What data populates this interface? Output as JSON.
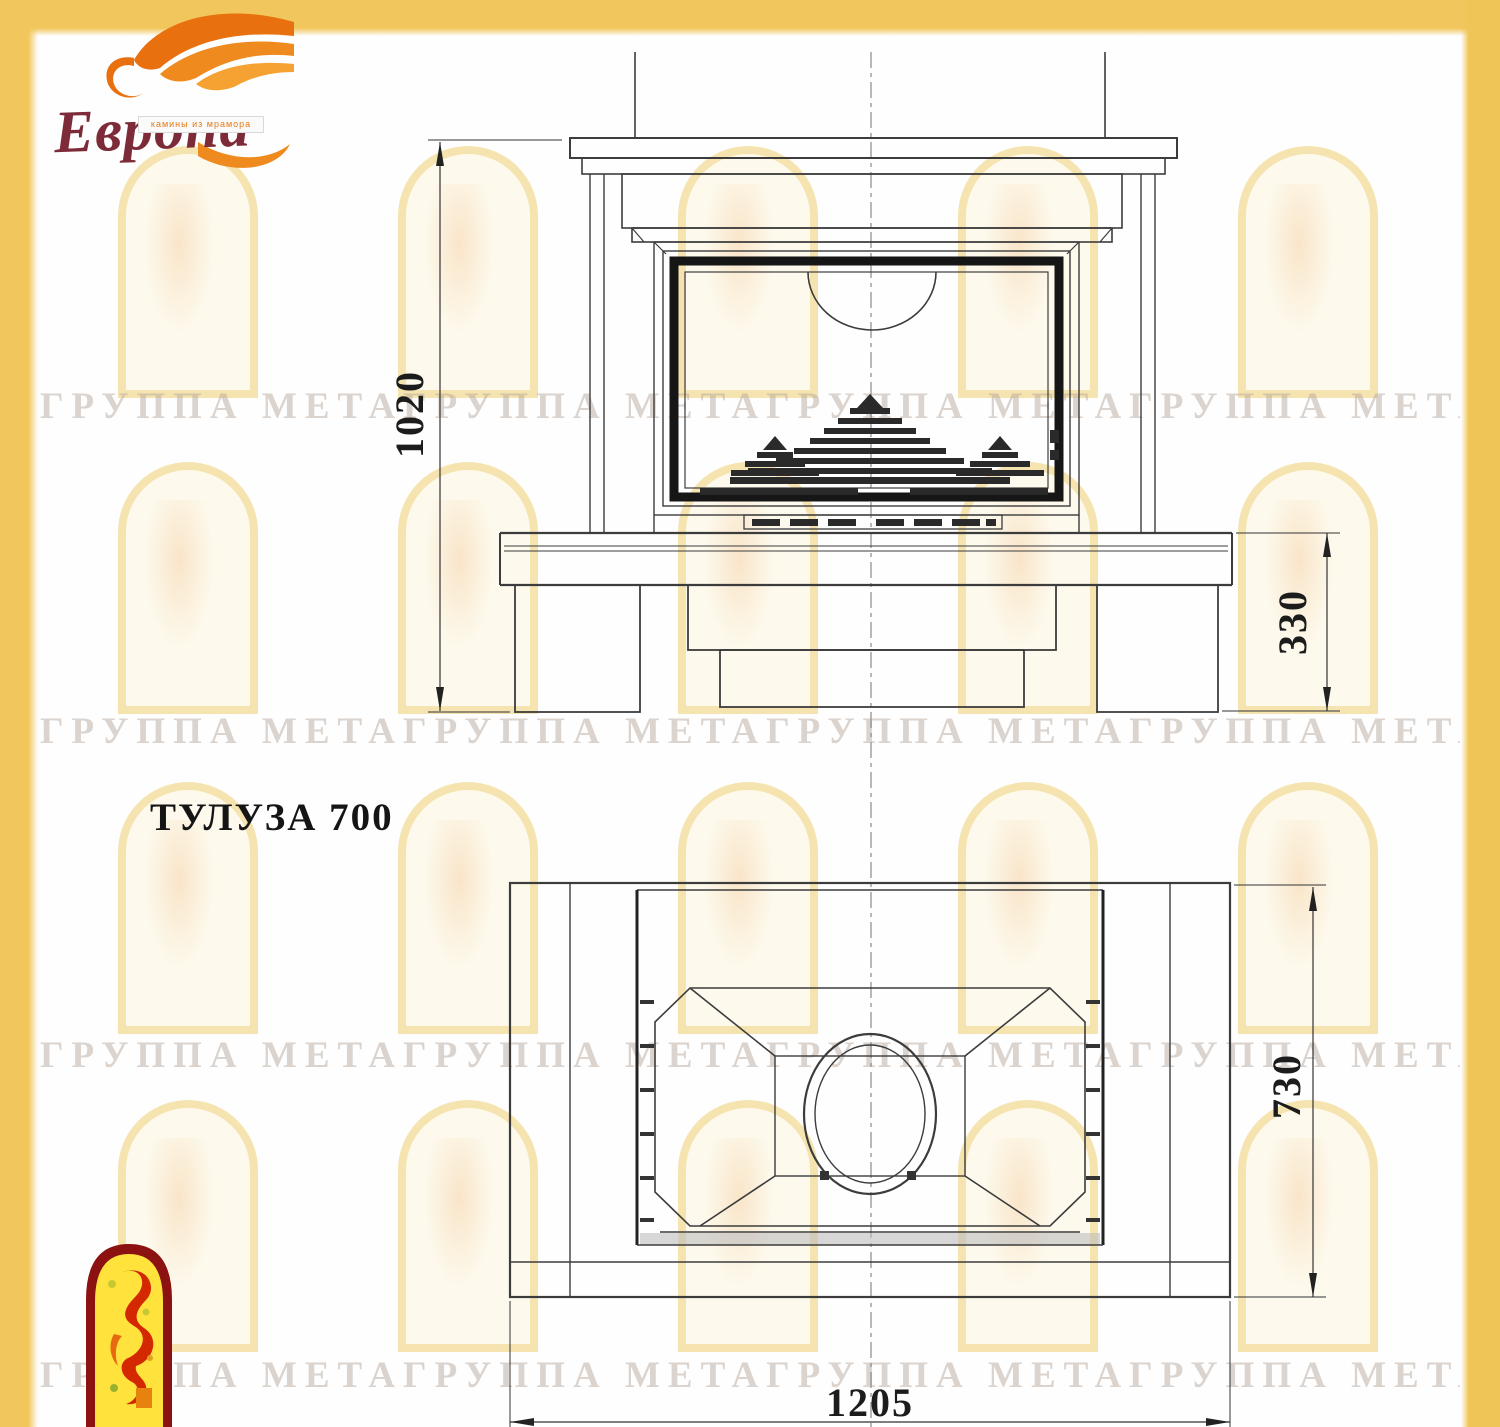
{
  "logo": {
    "brand": "Европа",
    "tagline": "камины из мрамора"
  },
  "title": "ТУЛУЗА 700",
  "dimensions": {
    "front_height_mm": "1020",
    "plinth_height_mm": "330",
    "plan_depth_mm": "730",
    "plan_width_mm": "1205"
  },
  "watermark": {
    "band_text": "ГРУППА МЕТАГРУППА МЕТАГРУППА МЕТАГРУППА МЕТА"
  },
  "colors": {
    "border_gold": "#f1c65c",
    "drawing_line": "#3c3c3c",
    "door_frame_black": "#161616",
    "flame_orange": "#e8750f",
    "brand_red": "#7d2b38",
    "emblem_red": "#8c1111",
    "emblem_yellow": "#ffe23c"
  }
}
